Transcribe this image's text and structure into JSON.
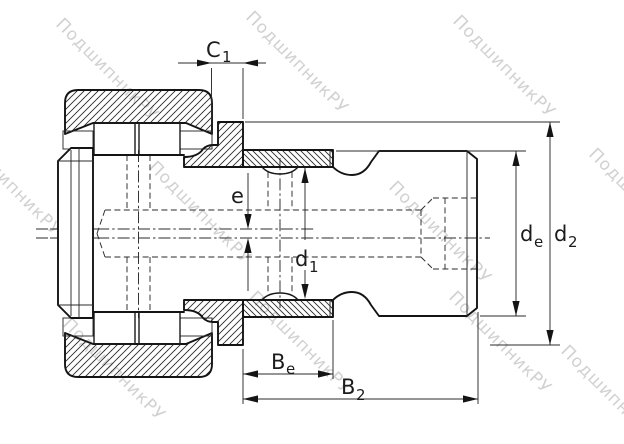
{
  "drawing": {
    "dimensions": {
      "c1": {
        "main": "C",
        "sub": "1"
      },
      "e": {
        "main": "e",
        "sub": ""
      },
      "d1": {
        "main": "d",
        "sub": "1"
      },
      "de": {
        "main": "d",
        "sub": "e"
      },
      "d2": {
        "main": "d",
        "sub": "2"
      },
      "be": {
        "main": "B",
        "sub": "e"
      },
      "b2": {
        "main": "B",
        "sub": "2"
      }
    }
  },
  "watermark": {
    "text": "ПодшипникРУ",
    "color": "#c6c6c6"
  },
  "colors": {
    "line": "#141414",
    "background": "#ffffff"
  }
}
